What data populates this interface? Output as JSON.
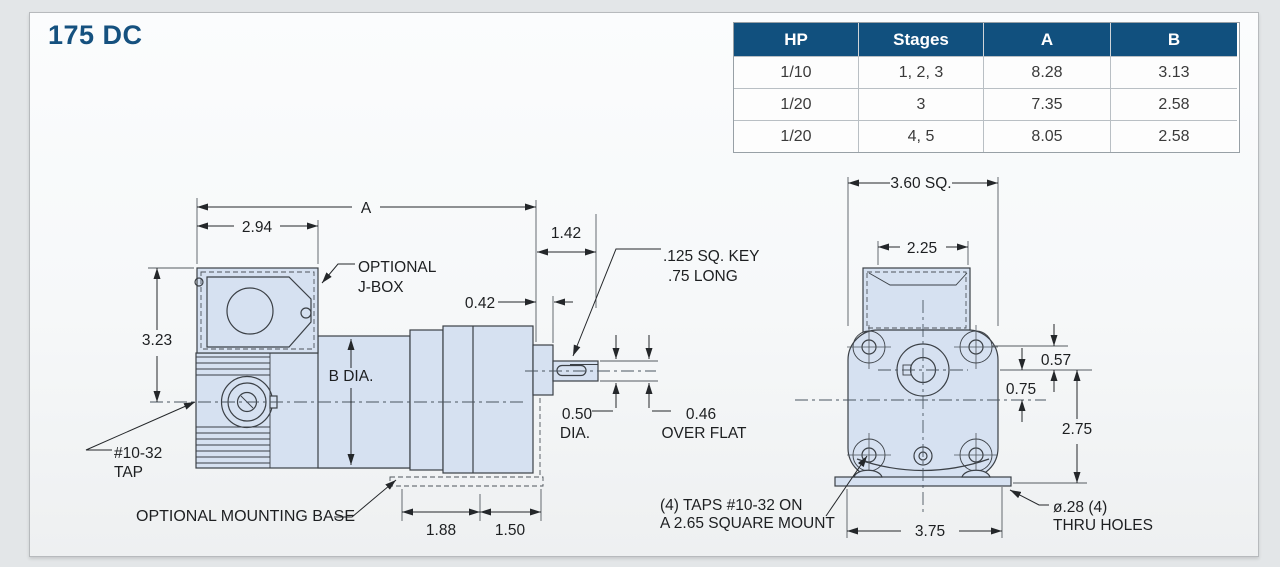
{
  "window": {
    "title": "175 DC"
  },
  "spec_table": {
    "headers": [
      "HP",
      "Stages",
      "A",
      "B"
    ],
    "rows": [
      [
        "1/10",
        "1, 2, 3",
        "8.28",
        "3.13"
      ],
      [
        "1/20",
        "3",
        "7.35",
        "2.58"
      ],
      [
        "1/20",
        "4, 5",
        "8.05",
        "2.58"
      ]
    ]
  },
  "colors": {
    "header_navy": "#11507e",
    "title_blue": "#15517f",
    "drawing_fill_blue": "#d6e1f1",
    "line_dark": "#3b4046"
  },
  "side_view": {
    "dims": {
      "overall_a": "A",
      "jbox_width": "2.94",
      "height_to_centerline": "3.23",
      "shaft_extension": "1.42",
      "boss_depth": "0.42",
      "body_diameter": "B DIA.",
      "shaft_dia_value": "0.50",
      "shaft_dia_unit": "DIA.",
      "flat_value": "0.46",
      "flat_label": "OVER FLAT",
      "base_seg1": "1.88",
      "base_seg2": "1.50"
    },
    "notes": {
      "jbox_1": "OPTIONAL",
      "jbox_2": "J-BOX",
      "key_1": ".125 SQ. KEY",
      "key_2": ".75 LONG",
      "tap_1": "#10-32",
      "tap_2": "TAP",
      "mounting_base": "OPTIONAL MOUNTING BASE"
    }
  },
  "front_view": {
    "dims": {
      "square": "3.60 SQ.",
      "motor_width": "2.25",
      "hole_offset": "0.57",
      "shaft_offset": "0.75",
      "shaft_to_base": "2.75",
      "bolt_span": "3.75"
    },
    "notes": {
      "taps_1": "(4) TAPS #10-32 ON",
      "taps_2": "A 2.65 SQUARE MOUNT",
      "holes_1": "ø.28 (4)",
      "holes_2": "THRU HOLES"
    }
  }
}
